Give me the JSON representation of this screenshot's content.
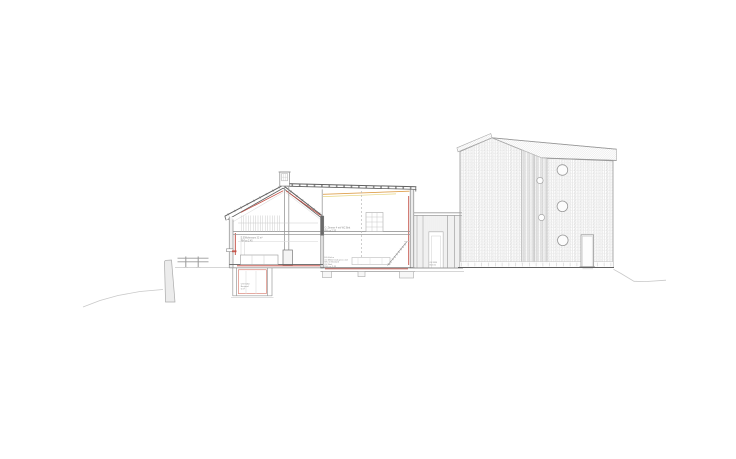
{
  "drawing": {
    "title": "building-section-and-elevation",
    "colors": {
      "line_light": "#c9c9c9",
      "line_mid": "#9a9a9a",
      "line_dark": "#606060",
      "accent_red": "#c0453a",
      "accent_orange": "#dfa14f",
      "accent_yellow": "#e6d47f",
      "text_gray": "#8a8a8a",
      "wall_fill": "#ececec",
      "wall_dark": "#6a6a6a"
    },
    "annotations": {
      "room_upper_left": {
        "lines": [
          "2.5 Wohnraum 32 m²",
          "RH ca 2.45"
        ]
      },
      "room_upper_right": {
        "lines": [
          "O. Zimmer 4 mit WC Bett",
          "RH ca 2.35"
        ]
      },
      "room_lower_right": {
        "lines": [
          "EG Küche",
          "mit Möbel statt gross und",
          "WC im Bestand",
          "OK Bod.",
          "RH: ca. 2.35"
        ]
      },
      "basement": {
        "lines": [
          "UG Keller",
          "Bestand",
          "6 m²"
        ]
      },
      "connector": {
        "lines": [
          "OK FFB",
          "652.50"
        ]
      }
    }
  }
}
